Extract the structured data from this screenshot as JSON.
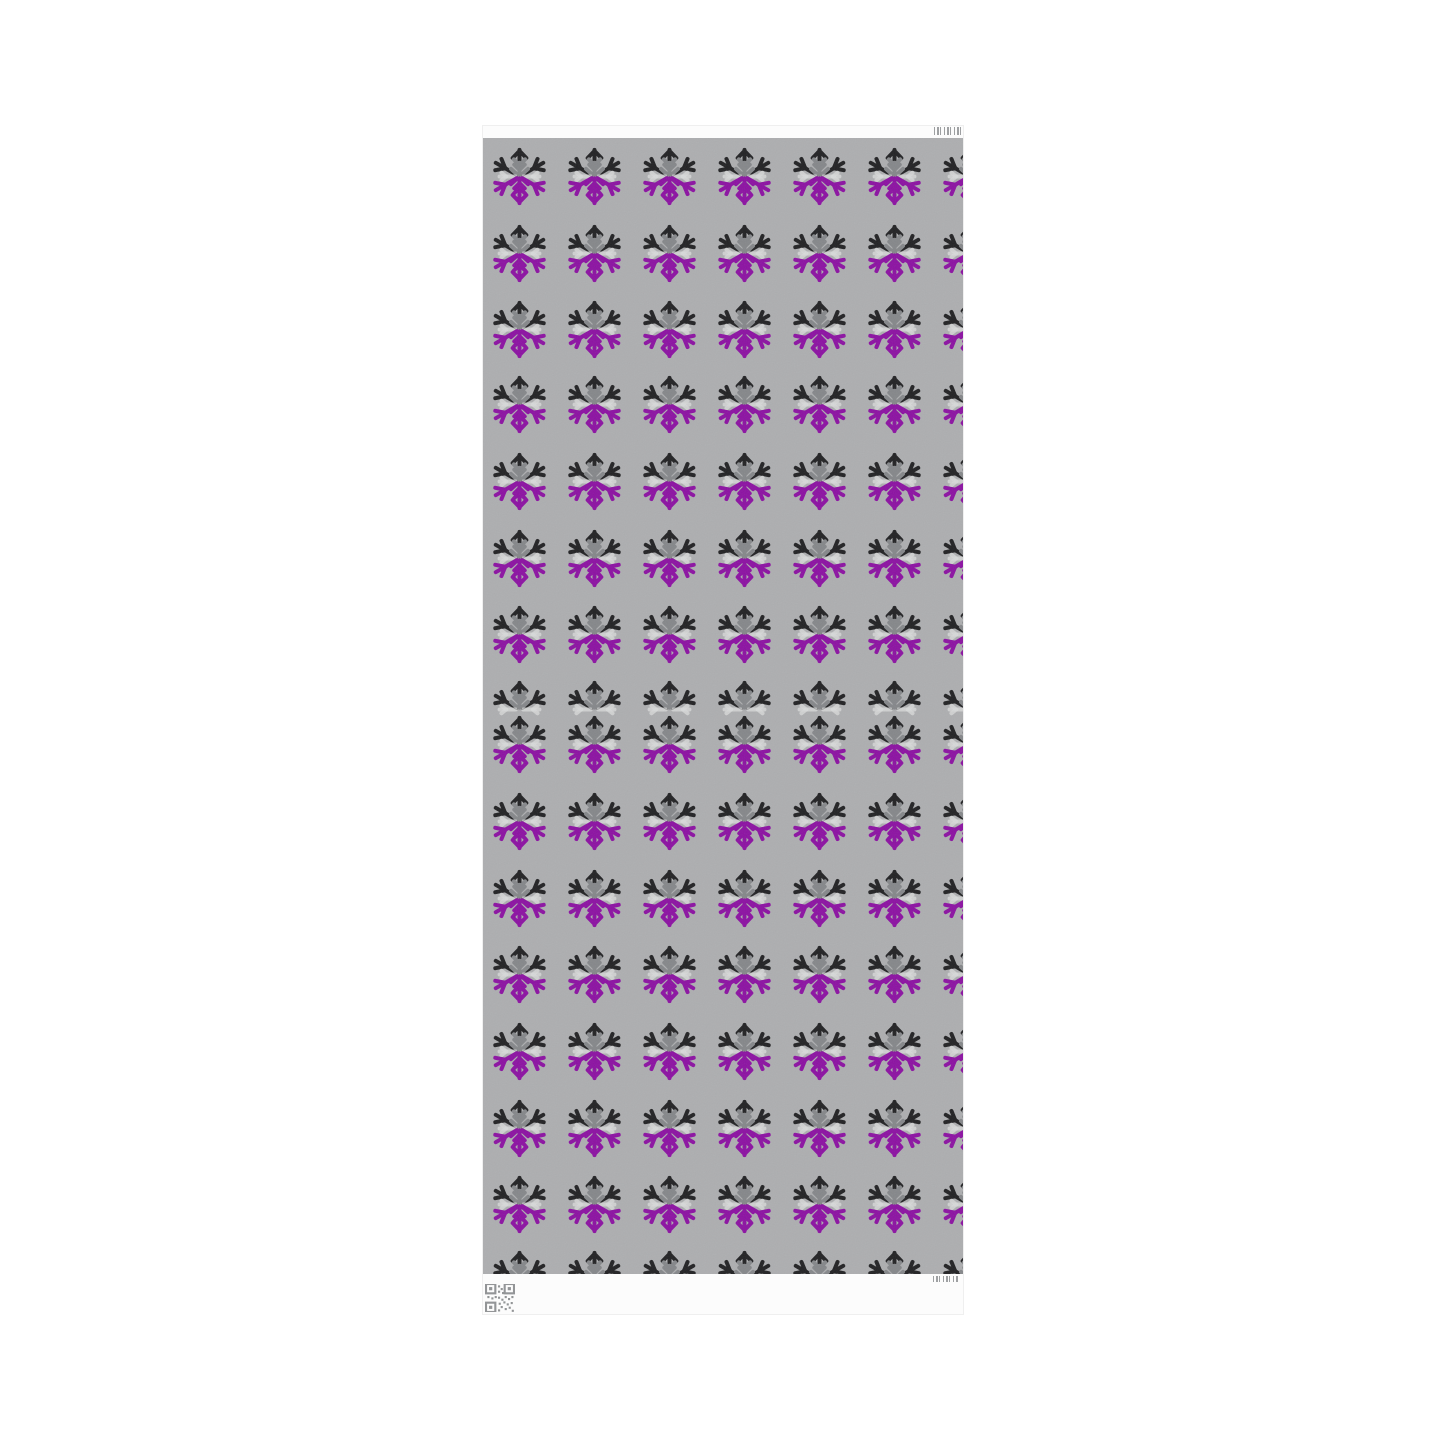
{
  "page": {
    "background_color": "#ffffff"
  },
  "paper": {
    "edge_color": "#fbfbfb",
    "strip_color": "#fcfcfc",
    "pattern_background": "#adaeb0",
    "left": 483,
    "top": 126,
    "width": 480,
    "height": 1188,
    "top_strip_height": 12,
    "bottom_strip_height": 40
  },
  "icons": {
    "motif": "snowflake-icon",
    "top_right": "barcode-icon",
    "bottom_right": "barcode-icon",
    "bottom_left": "qr-code-icon"
  },
  "motif_colors": {
    "black": "#222224",
    "gray": "#85878a",
    "white": "#e2e4e4",
    "purple": "#8c12a2",
    "barcode": "#8e9092",
    "qr": "#939597"
  },
  "pattern_grid": {
    "flake_size": 57,
    "columns": {
      "start_x": 8,
      "pitch": 75,
      "count": 7
    },
    "rows": [
      {
        "y": 10,
        "type": "full"
      },
      {
        "y": 87,
        "type": "full"
      },
      {
        "y": 163,
        "type": "full"
      },
      {
        "y": 238,
        "type": "full"
      },
      {
        "y": 315,
        "type": "full"
      },
      {
        "y": 392,
        "type": "full"
      },
      {
        "y": 468,
        "type": "full"
      },
      {
        "y": 543,
        "type": "half"
      },
      {
        "y": 578,
        "type": "full"
      },
      {
        "y": 655,
        "type": "full"
      },
      {
        "y": 732,
        "type": "full"
      },
      {
        "y": 808,
        "type": "full"
      },
      {
        "y": 885,
        "type": "full"
      },
      {
        "y": 962,
        "type": "full"
      },
      {
        "y": 1038,
        "type": "full"
      },
      {
        "y": 1113,
        "type": "full"
      }
    ]
  }
}
